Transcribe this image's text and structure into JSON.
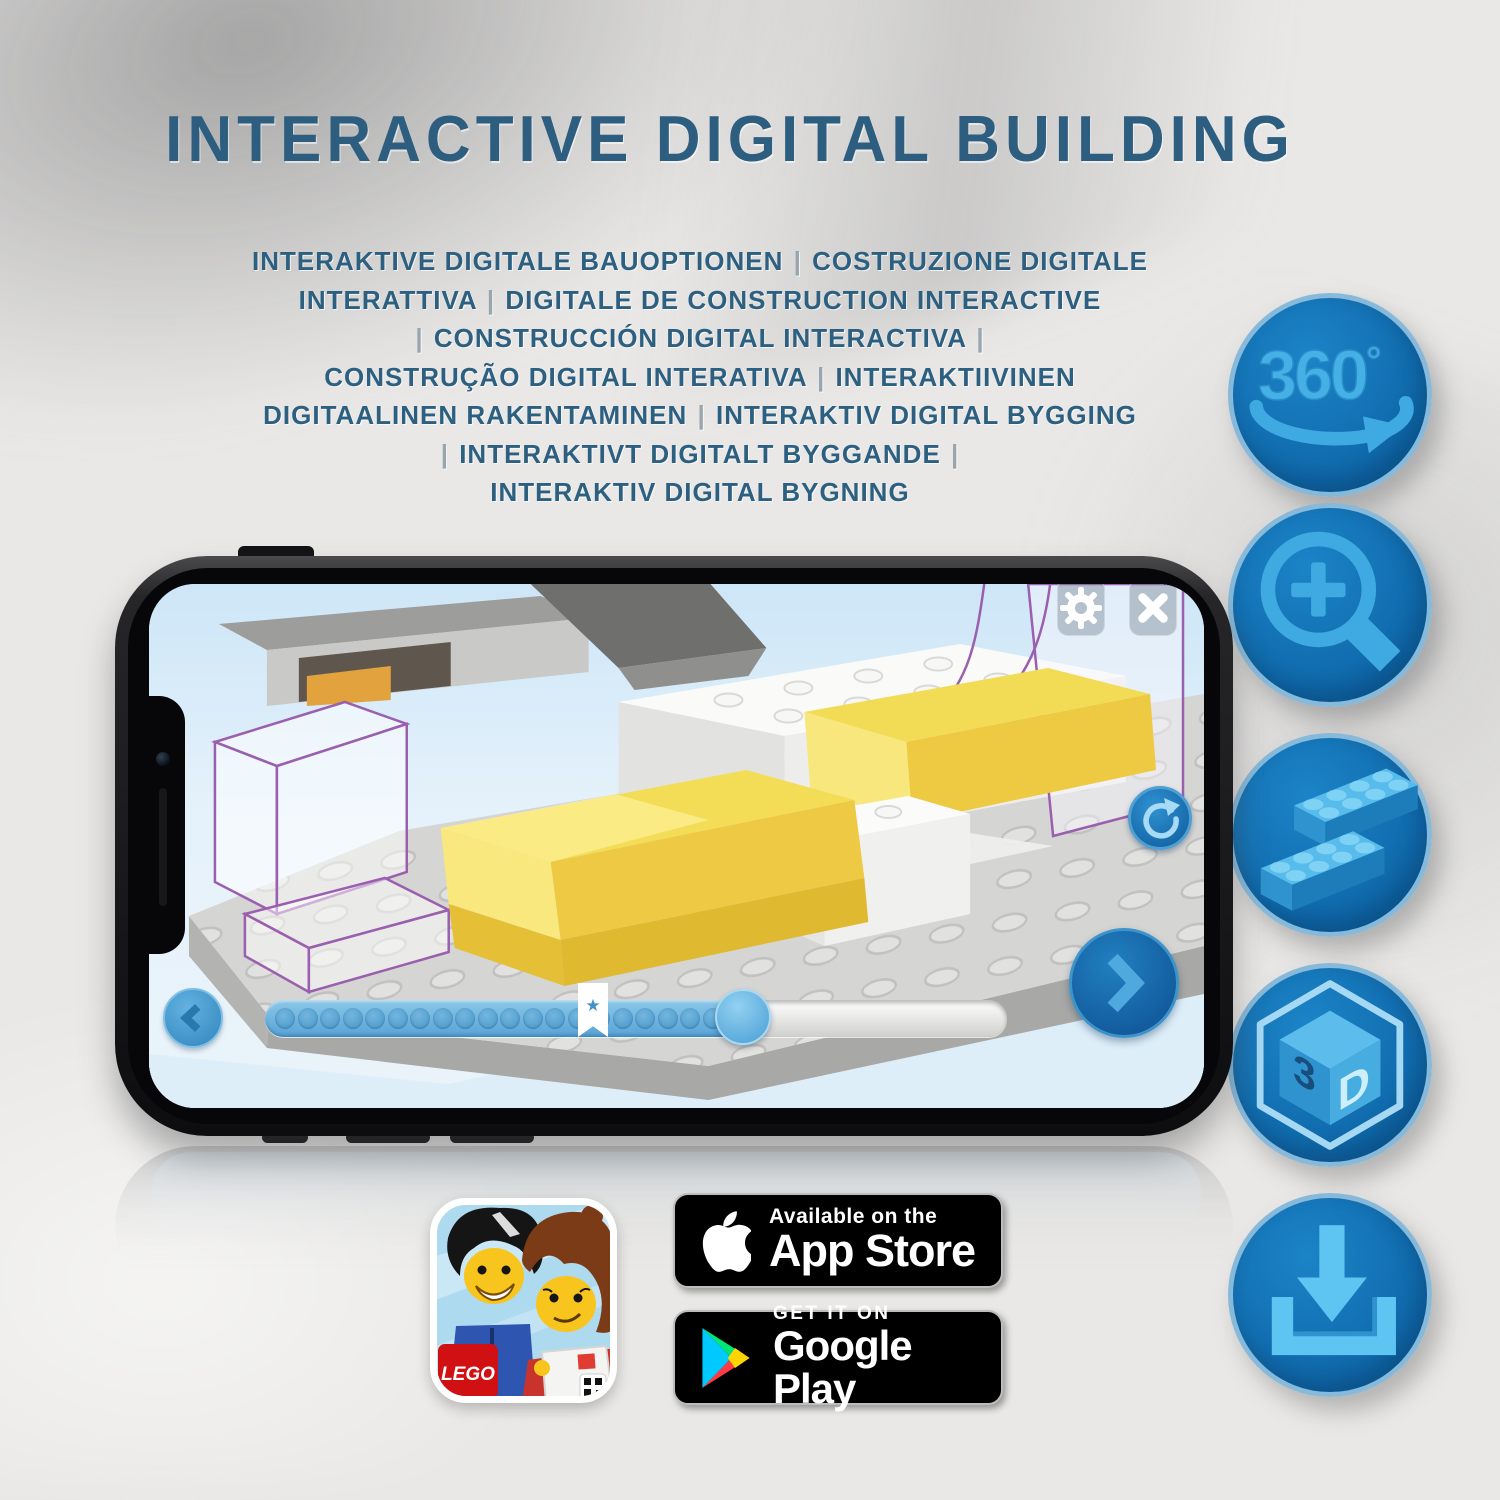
{
  "page": {
    "title": "INTERACTIVE DIGITAL BUILDING",
    "subtitle_lines": [
      "INTERAKTIVE DIGITALE BAUOPTIONEN | COSTRUZIONE DIGITALE",
      "INTERATTIVA | DIGITALE DE CONSTRUCTION INTERACTIVE",
      "| CONSTRUCCIÓN DIGITAL INTERACTIVA |",
      "CONSTRUÇÃO DIGITAL INTERATIVA | INTERAKTIIVINEN",
      "DIGITAALINEN RAKENTAMINEN | INTERAKTIV DIGITAL BYGGING",
      "| INTERAKTIVT DIGITALT BYGGANDE |",
      "INTERAKTIV DIGITAL BYGNING"
    ]
  },
  "features": {
    "rotate_360": {
      "value": "360",
      "degree": "°"
    },
    "cube_3d": {
      "left": "3",
      "right": "D"
    }
  },
  "phone_app": {
    "progress": {
      "dot_count": 20,
      "thumb_percent": 64,
      "bookmark_percent": 44
    }
  },
  "store_badges": {
    "app_store": {
      "line1": "Available on the",
      "line2": "App Store"
    },
    "google_play": {
      "line1": "GET IT ON",
      "line2": "Google Play"
    }
  },
  "app_icon": {
    "logo_text": "LEGO"
  },
  "colors": {
    "heading_blue": "#2d5e80",
    "badge_circle_blue": "#0f6cb0",
    "glyph_light_blue": "#45aee6",
    "phone_frame": "#1b1b1d",
    "progress_fill_blue": "#5ba6d8",
    "brick_yellow": "#f2dc55",
    "ghost_outline_purple": "#9a5fae",
    "lego_logo_red": "#d01012",
    "play_cyan": "#00c9ff",
    "play_green": "#00e673",
    "play_red": "#ff3a44",
    "play_yellow": "#ffd400"
  }
}
